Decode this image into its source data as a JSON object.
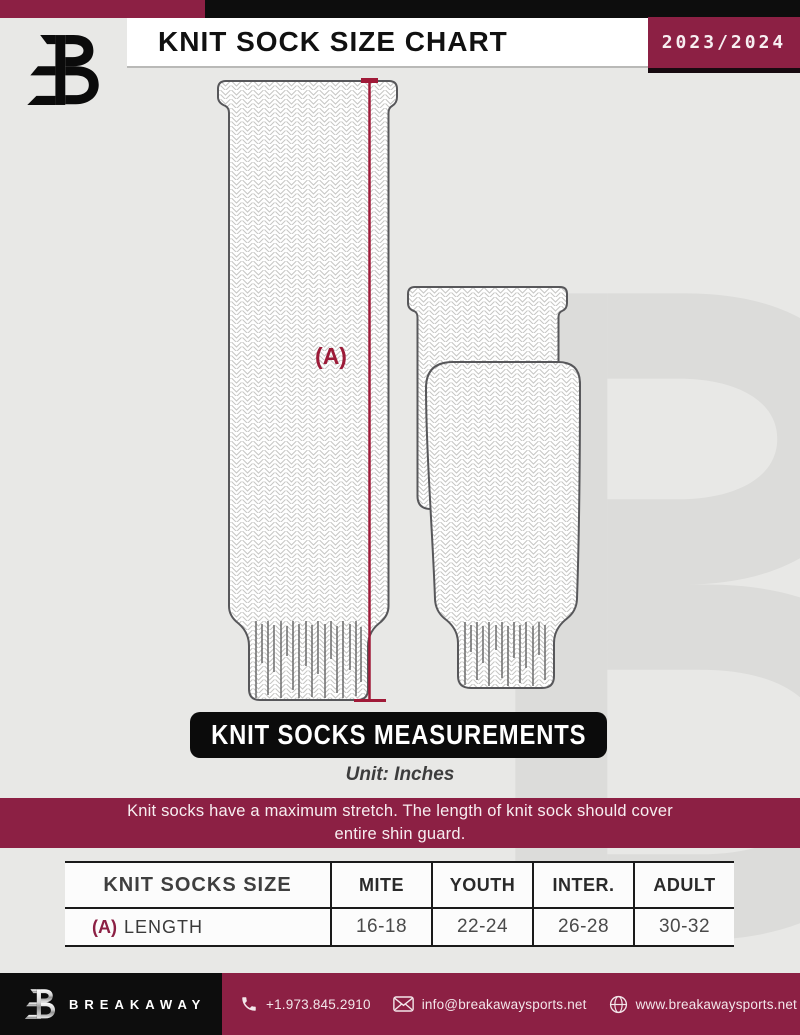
{
  "header": {
    "top_title": "KNIT SOCK SIZE CHART",
    "season": "2023/2024"
  },
  "diagram": {
    "dimension_label": "(A)",
    "banner_title": "KNIT SOCKS MEASUREMENTS",
    "unit_note": "Unit: Inches"
  },
  "notice": {
    "line1": "Knit socks have a maximum stretch. The length of knit sock should cover",
    "line2": "entire shin guard."
  },
  "size_table": {
    "row_header": "KNIT SOCKS SIZE",
    "size_columns": [
      "MITE",
      "YOUTH",
      "INTER.",
      "ADULT"
    ],
    "rows": [
      {
        "dim": "(A)",
        "label": "LENGTH",
        "values": [
          "16-18",
          "22-24",
          "26-28",
          "30-32"
        ]
      }
    ]
  },
  "footer": {
    "brand": "BREAKAWAY",
    "phone": "+1.973.845.2910",
    "email": "info@breakawaysports.net",
    "website": "www.breakawaysports.net"
  },
  "icons": {
    "brand_logo": "breakaway-b-logo",
    "phone": "phone-icon",
    "email": "envelope-icon",
    "website": "globe-icon"
  },
  "colors": {
    "maroon": "#8c2044",
    "crimson": "#a01a38",
    "page_background": "#e8e8e6",
    "black": "#0d0d0d",
    "watermark": "#dcdcda"
  }
}
